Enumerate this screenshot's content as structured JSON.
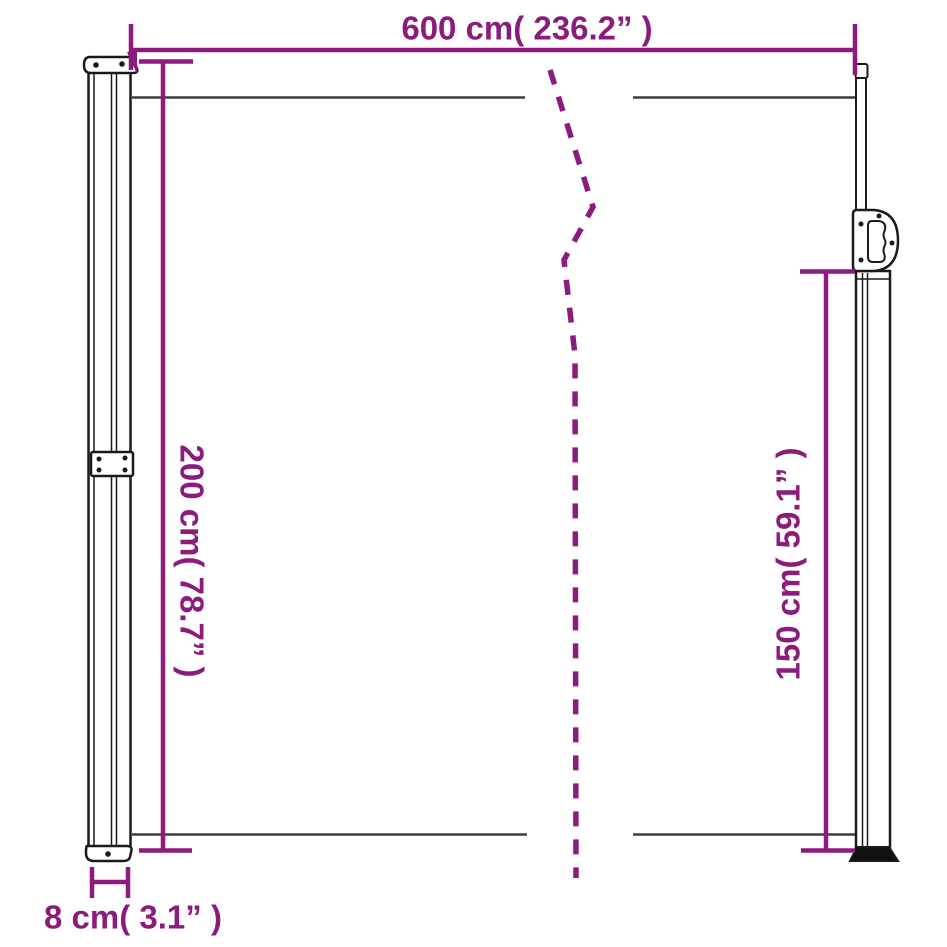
{
  "diagram": {
    "title": "retractable side awning dimension diagram",
    "labels": {
      "width": "600 cm( 236.2” )",
      "height": "200 cm( 78.7” )",
      "front_height": "150 cm( 59.1” )",
      "depth": "8 cm( 3.1” )"
    },
    "colors": {
      "accent": "#8B1B7D",
      "outline": "#1a1a1a",
      "fabric_line": "#3d3d3d",
      "background": "#ffffff"
    }
  }
}
